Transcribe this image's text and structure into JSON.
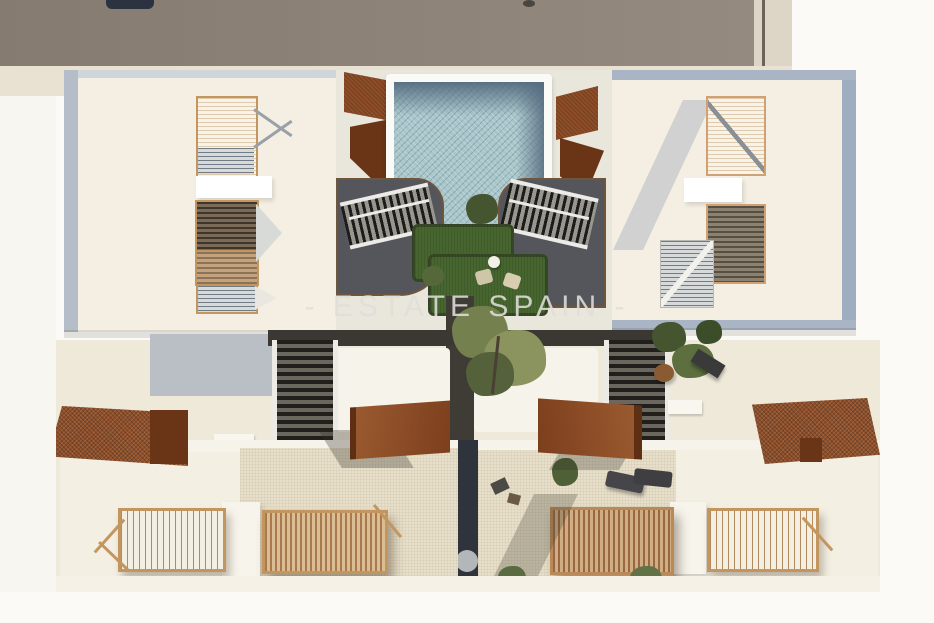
{
  "watermark": {
    "text": "- ESTATE SPAIN -"
  },
  "palette": {
    "bg": "#fbfaf6",
    "neighbor-roof": "#8b8177",
    "street-cream": "#e9e2d2",
    "roof-cream": "#f4efe2",
    "terrace-tan": "#e7dfc9",
    "parapet-blue": "#a9b5c4",
    "pool-water": "#a9c6ca",
    "pool-deep": "#5d7689",
    "deck-gray": "#55565c",
    "deck-trim": "#6f553c",
    "lawn": "#47662f",
    "foliage": "#44552f",
    "foliage-light": "#8b935f",
    "corten": "#8e4e28",
    "corten-dark": "#6a3517",
    "wood-frame": "#c4965f",
    "wood-slat": "#aa7a4e",
    "slat-dark": "#3f362b",
    "slat-gray": "#9aa3ab",
    "walkway": "#3f3b35",
    "gap-dark": "#2e333c",
    "white-warm": "#f6f3eb",
    "watermark-color": "#e0dfda"
  }
}
